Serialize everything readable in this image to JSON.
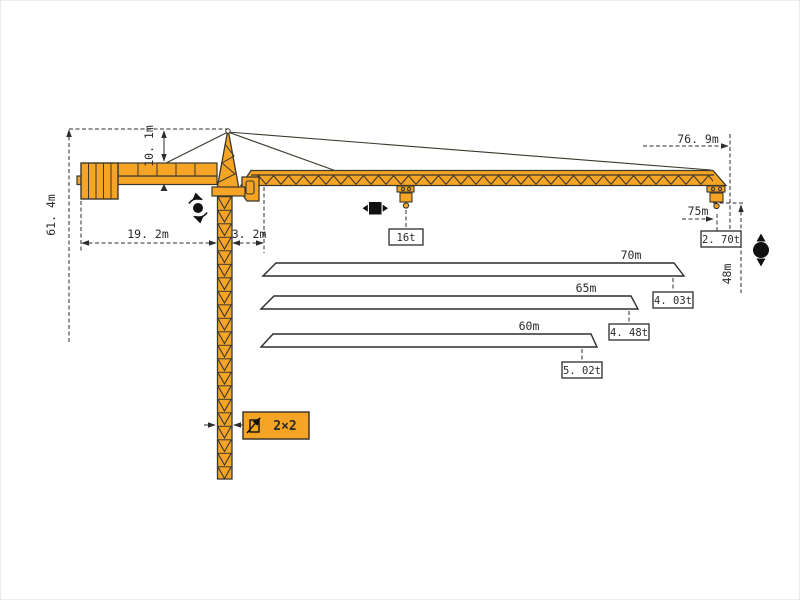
{
  "diagram_type": "tower-crane-specification-diagram",
  "dimensions": {
    "total_height": "61. 4m",
    "head_height": "10. 1m",
    "counter_jib_length": "19. 2m",
    "jib_root_offset": "3. 2m",
    "jib_reach": "76. 9m",
    "max_radius": "75m",
    "hook_height": "48m"
  },
  "loads": {
    "max_load": "16t",
    "tip_load": "2. 70t"
  },
  "mast": {
    "section": "2×2"
  },
  "jib_options": [
    {
      "length": "70m",
      "tip_load": "4. 03t"
    },
    {
      "length": "65m",
      "tip_load": "4. 48t"
    },
    {
      "length": "60m",
      "tip_load": "5. 02t"
    }
  ],
  "icons": {
    "slewing": "slewing-rotation-icon",
    "trolley": "trolley-travel-icon",
    "hoisting": "hoisting-up-down-icon",
    "mast_section": "mast-section-icon"
  },
  "colors": {
    "crane": "#F6A425",
    "outline": "#3B382C",
    "dimension": "#2D2D2D",
    "background": "#FFFFFF"
  }
}
